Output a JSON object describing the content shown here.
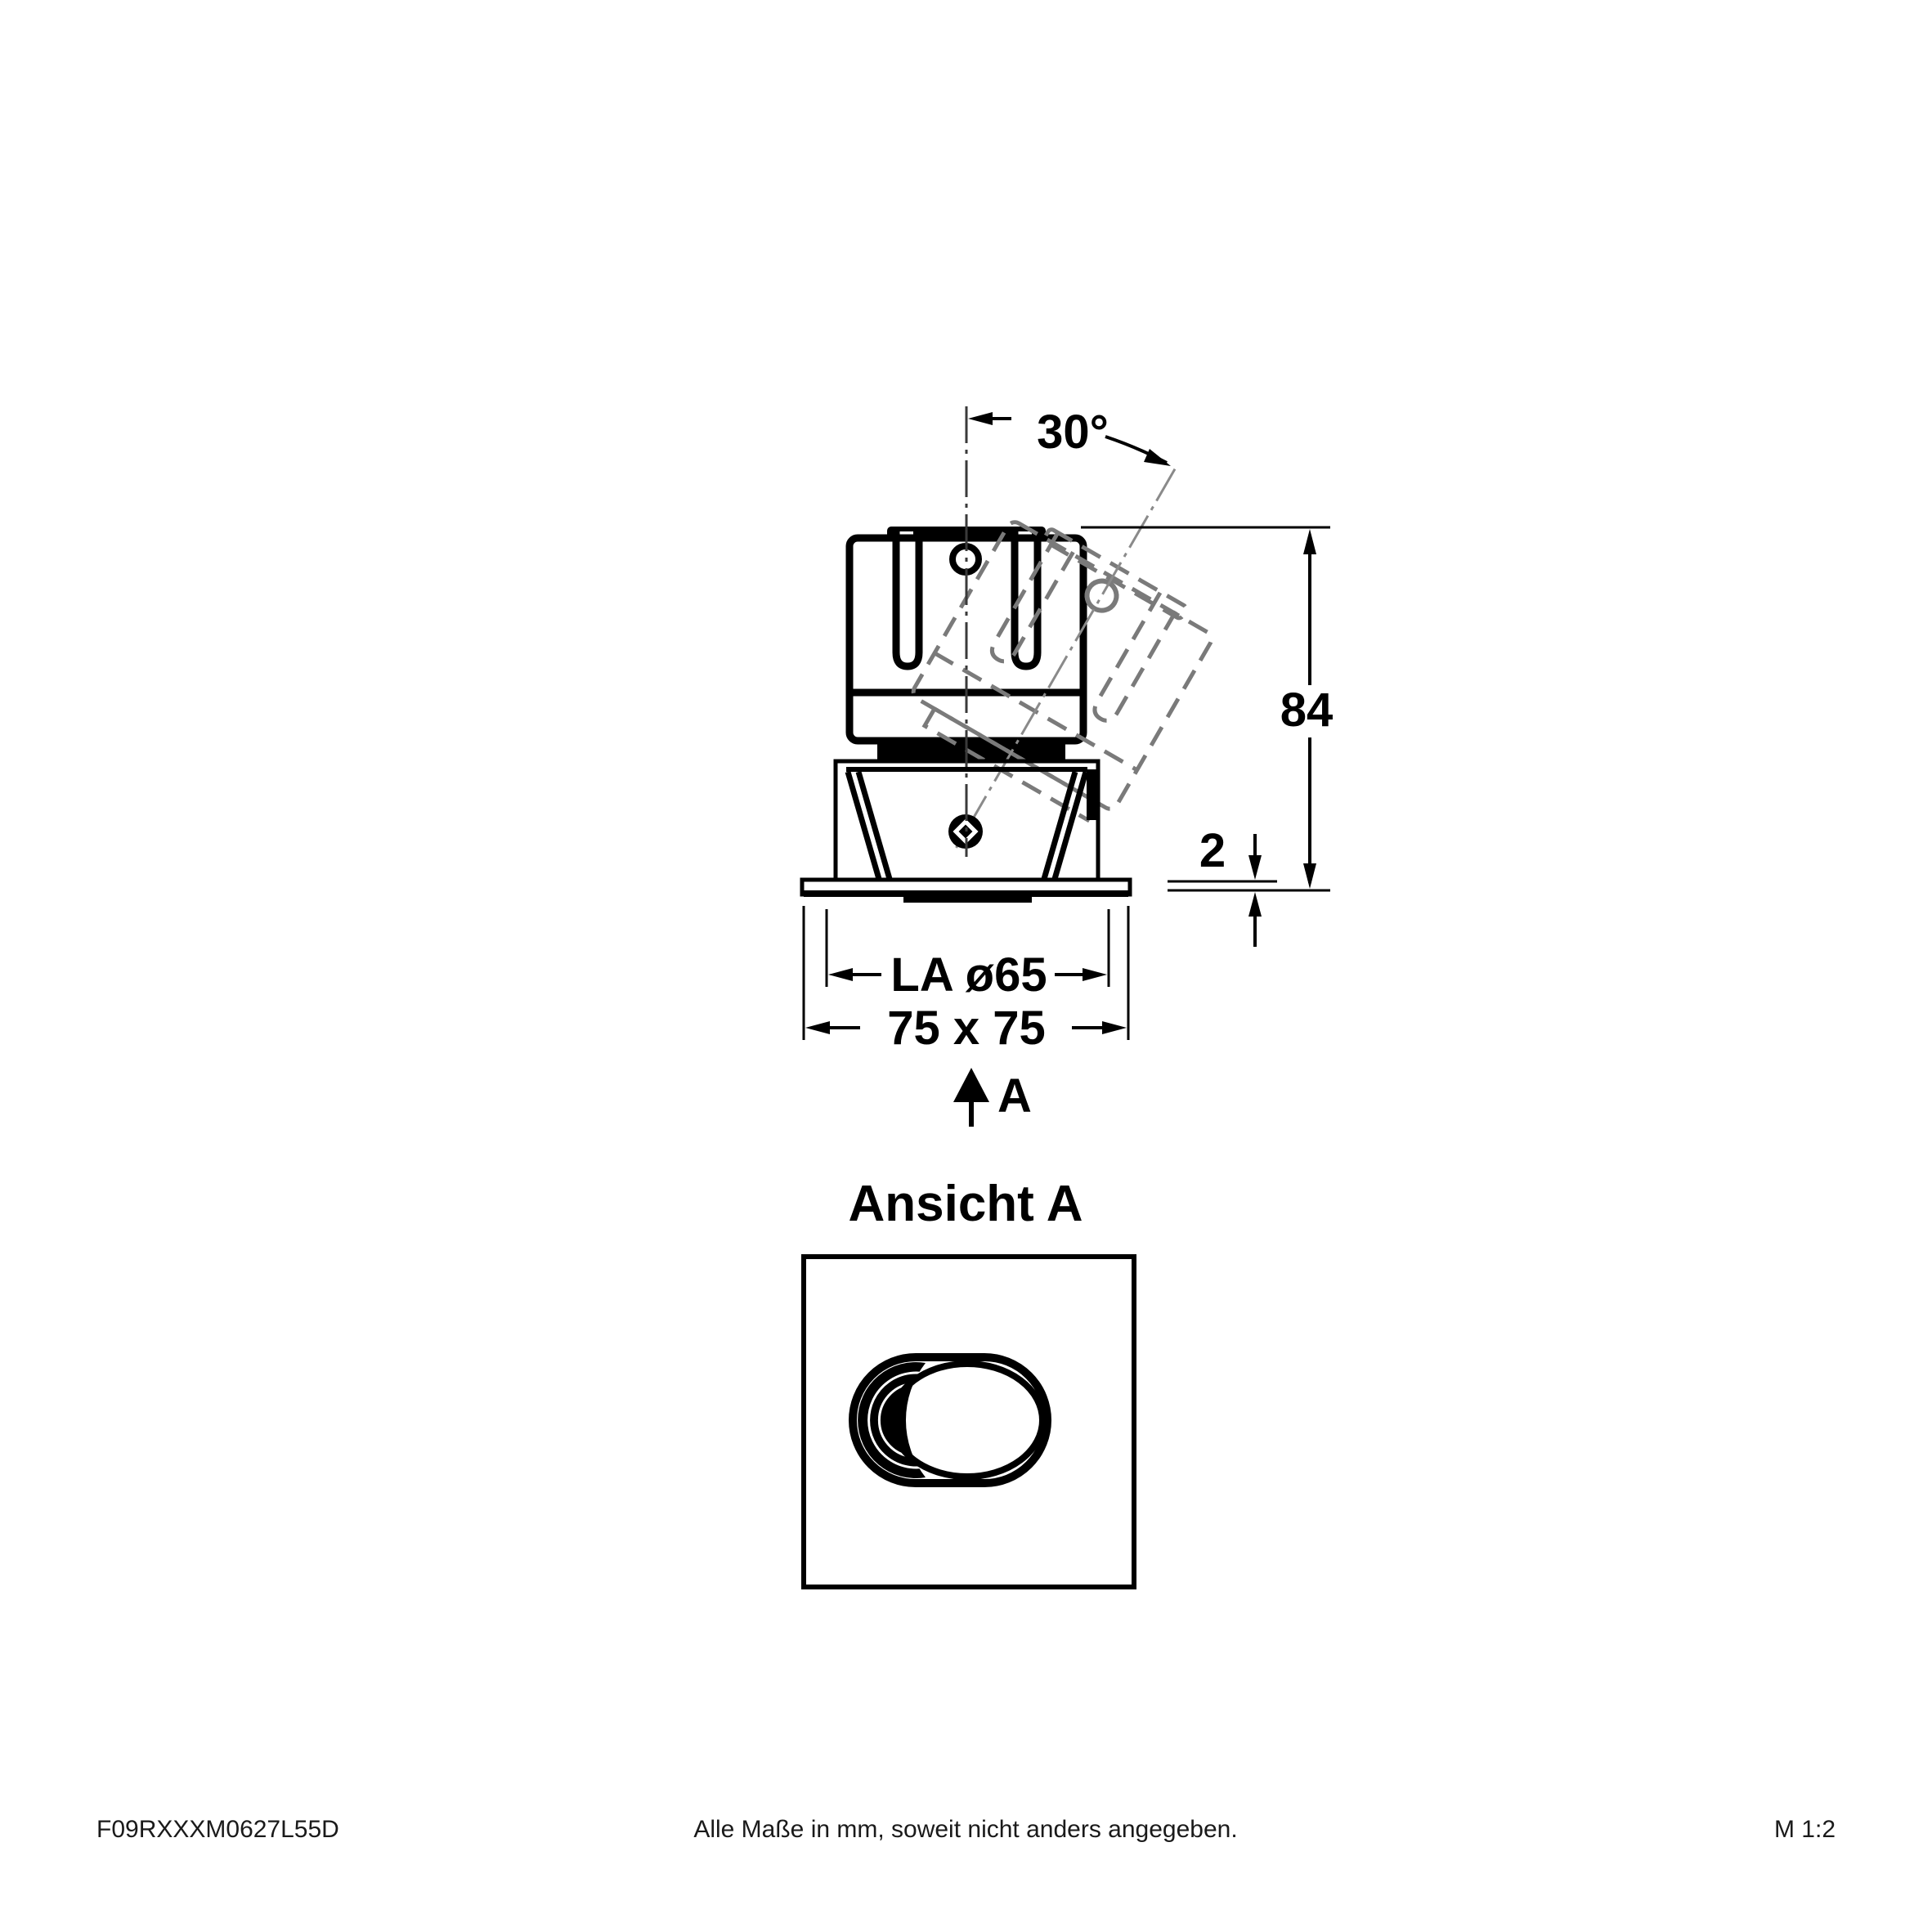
{
  "drawing": {
    "labels": {
      "angle": "30°",
      "height": "84",
      "flange_thickness": "2",
      "cutout": "LA ø65",
      "overall": "75 x 75",
      "view_arrow": "A",
      "view_title": "Ansicht A"
    },
    "colors": {
      "line": "#000000",
      "ghost_line": "#7a7a7a",
      "background": "#ffffff"
    }
  },
  "footer": {
    "code": "F09RXXXM0627L55D",
    "note": "Alle Maße in mm, soweit nicht anders angegeben.",
    "scale": "M 1:2"
  }
}
